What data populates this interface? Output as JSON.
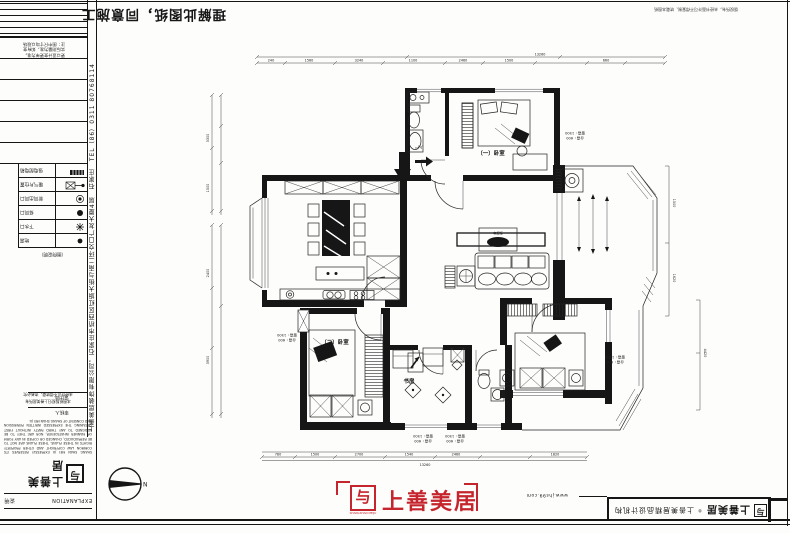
{
  "frame": {
    "approval_title": "理解此图纸，同意施工",
    "top_right_note": "版权所有，未经书面许可不得复制、转载本图纸",
    "website": "www.jhs99.com"
  },
  "title_block": {
    "note_lines": [
      "注：图中尺寸均以现场",
      "实际测量为准，如有变",
      "更以设计变更单为准。"
    ],
    "company_vertical": "上善美居装饰有限公司，石家庄市桥西区红旗大街与南二环交口广友大厦4层　石家庄　TEL（86）0311 80768114",
    "legend": [
      {
        "label": "强电配电箱"
      },
      {
        "label": "暖气片位置"
      },
      {
        "label": "新风出风口"
      },
      {
        "label": "排风口"
      },
      {
        "label": "下水口"
      },
      {
        "label": "地漏"
      }
    ],
    "note_row": "（图例说明）",
    "sign1": "设计师",
    "sign2": "审核人"
  },
  "footer_left": {
    "notice_lines": [
      "本图纸版权归上善美居所有",
      "未经许可不得转载，违者必究"
    ],
    "copyright_text": "SHANG SHAN MEI JU EXPRESSLY RESERVES ITS COMMON LAW COPYRIGHT AND OTHER PROPERTY RIGHTS IN THESE PLANS. THESE PLANS ARE NOT TO BE REPRODUCED, CHANGED OR COPIED IN ANY FORM OR MANNER WHATSOEVER, NOR ARE THEY TO BE ASSIGNED TO ANY THIRD PARTY WITHOUT FIRST OBTAINING THE EXPRESSED WRITTEN PERMISSION AND CONSENT OF SHANG SHAN MEI JU.",
    "logo_glyph": "与",
    "logo_name": "上善美居",
    "explanation_en": "EXPLANATION",
    "explanation_cn": "说明"
  },
  "brand_center": {
    "glyph": "与",
    "name": "上善美居",
    "sub": "SHANGSHAN MEIJU"
  },
  "brand_right": {
    "glyph": "与",
    "name": "上善美居",
    "reg": "®",
    "tagline": "上善美居精品设计机构"
  },
  "north": {
    "label": "N"
  },
  "plan": {
    "labels": {
      "bedroom1": "（一）卧室",
      "bedroom2": "（二）卧室",
      "study": "书房",
      "tv_cabinet": "电视柜",
      "entry": "入户"
    },
    "annotations": [
      {
        "l1": "台高：600",
        "l2": "窗高：1500"
      },
      {
        "l1": "台高：600",
        "l2": "窗高：1500"
      },
      {
        "l1": "台高：600",
        "l2": "窗高：1500"
      },
      {
        "l1": "台高：600",
        "l2": "窗高：1500"
      },
      {
        "l1": "台高：600",
        "l2": "窗高：1500"
      }
    ],
    "dims": {
      "top": [
        "240",
        "1560",
        "3240",
        "1100",
        "2460",
        "1500",
        "660"
      ],
      "top_total": "13260",
      "bottom": [
        "780",
        "1500",
        "2700",
        "1540",
        "2460",
        "1820"
      ],
      "bottom_total": "13260",
      "left": [
        "3300",
        "1500",
        "2400",
        "3900"
      ],
      "right": [
        "1500",
        "1620",
        "4420"
      ]
    }
  }
}
